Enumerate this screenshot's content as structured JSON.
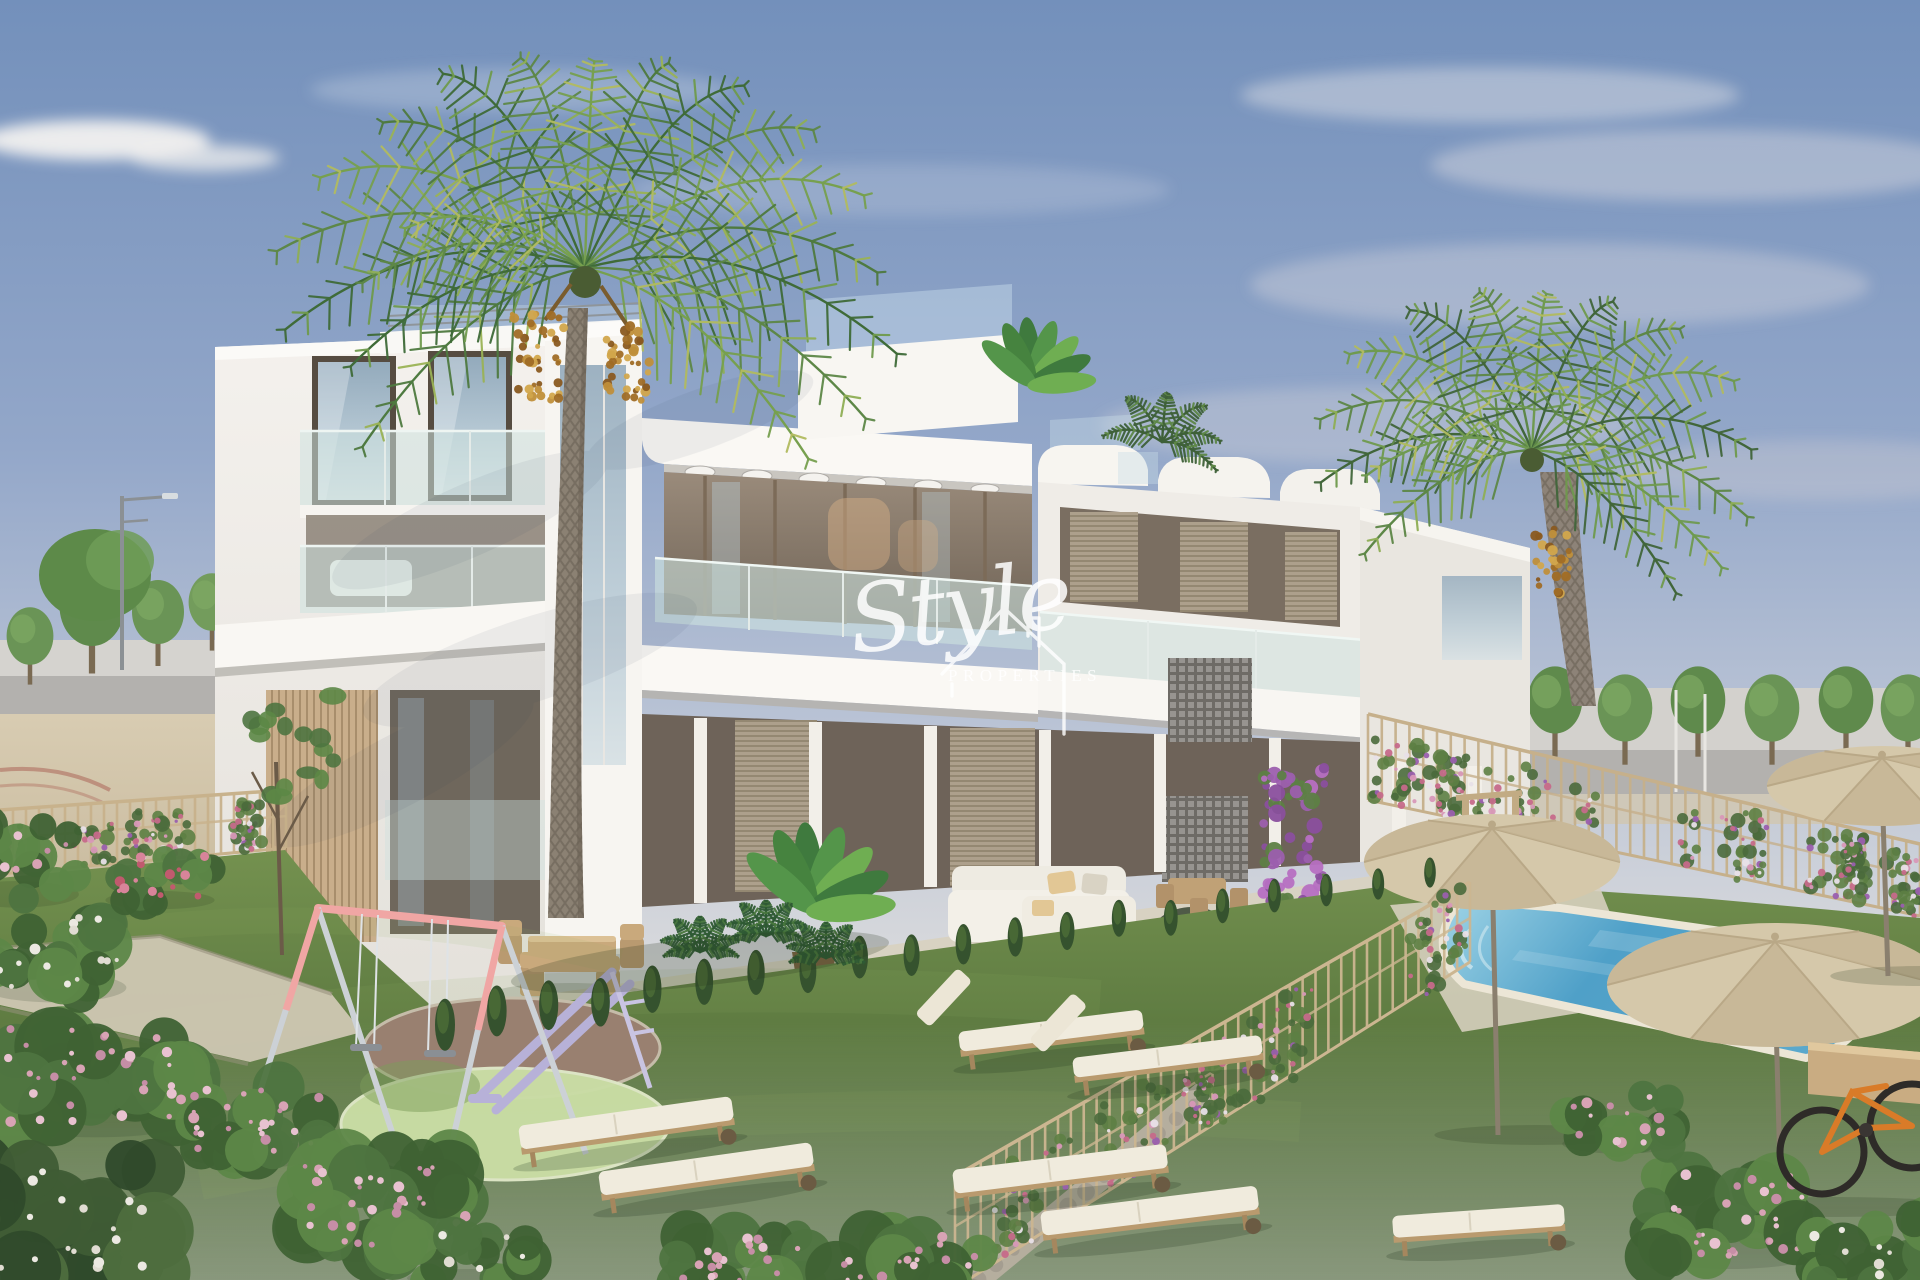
{
  "watermark": {
    "script_word": "Style",
    "caps_word": "PROPERTIES",
    "icon": "house-outline-icon",
    "color": "#ffffff"
  },
  "scene": {
    "type": "architectural-exterior-render",
    "description": "new-build-white-apartment-complex-with-communal-garden-playground-palm-trees-and-pool",
    "elements": [
      "sky",
      "clouds",
      "background-trees",
      "street-lamps",
      "road",
      "apartment-building",
      "roof-terrace-railing",
      "glass-balconies",
      "wood-slat-cladding",
      "lattice-breeze-blocks",
      "bougainvillea",
      "large-palm-tree",
      "right-palm-tree",
      "lawn",
      "garden-path",
      "flower-beds",
      "hedge-row",
      "playground-swing",
      "playground-slide",
      "play-surface-circles",
      "outdoor-dining-set",
      "outdoor-sofa",
      "potted-banana-plant",
      "swimming-pool",
      "pool-deck",
      "parasols",
      "garden-fences",
      "sun-loungers",
      "bicycle",
      "planter-box"
    ]
  },
  "palette": {
    "sky_top": "#7390bb",
    "sky_mid": "#9fb2cd",
    "sky_horizon": "#d8d9dc",
    "building_white": "#f7f5f1",
    "building_shade": "#e6e3de",
    "soffit": "#c9c6c0",
    "frame_dark": "#5f5549",
    "glass_blue": "#a9bfcb",
    "glass_teal": "#cde2df",
    "wood_slat": "#c9ae8b",
    "shutter": "#ada08c",
    "lattice": "#8f8c86",
    "palm_green": "#5d8747",
    "palm_green_light": "#8fae55",
    "trunk": "#8b8173",
    "dates": "#b98634",
    "lawn_far": "#72904f",
    "lawn_near": "#4d6a37",
    "pool_water": "#4fa0c8",
    "pool_coping": "#ece6d6",
    "parasol": "#d5c8aa",
    "fence_tan": "#c6b08b",
    "stone": "#b3ac9d",
    "path": "#cfc7b3",
    "deck": "#d6cfbe",
    "swing_pink": "#f0a6a4",
    "slide_lavender": "#b7b1d8",
    "rubber_brown": "#998070",
    "rubber_green": "#cadda5",
    "flower_pink": "#d6a6ba",
    "flower_purple": "#a46cb4",
    "cushion": "#f0ebdd",
    "wood_furniture": "#c3a478",
    "bike_orange": "#d97b28",
    "road": "#b3b1ae",
    "tree_green": "#6a9456"
  }
}
